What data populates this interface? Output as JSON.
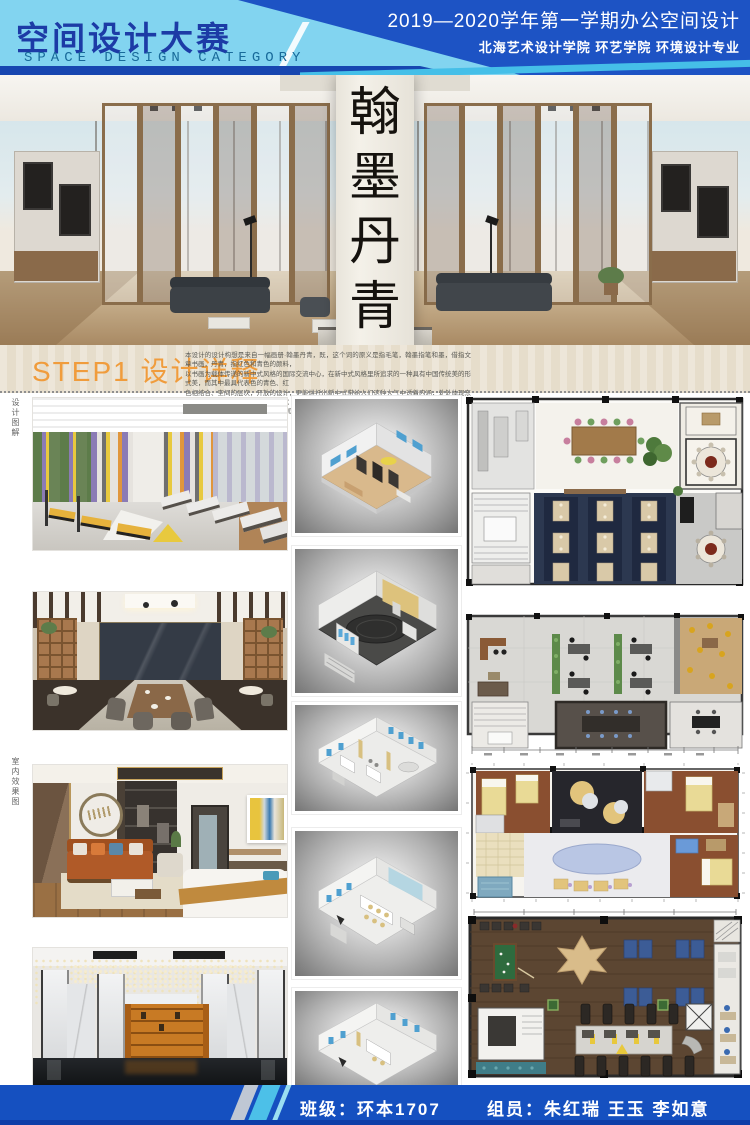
{
  "palette": {
    "header_light_blue": "#82d4f0",
    "header_royal_blue": "#1d53c4",
    "header_navy_text": "#1c3ba6",
    "header_en_text": "#186a9a",
    "accent_cyan": "#45bfe8",
    "step_orange": "#f09c3c",
    "footer_blue": "#1550c0",
    "plan_navy": "#2c3850",
    "axon_window_blue": "#4fa0d0"
  },
  "header": {
    "title_cn": "空间设计大赛",
    "title_en": "SPACE DESIGN CATEGORY",
    "session_line": "2019—2020学年第一学期办公空间设计",
    "school_line": "北海艺术设计学院  环艺学院  环境设计专业"
  },
  "hero": {
    "calligraphy_chars": [
      "翰",
      "墨",
      "丹",
      "青"
    ]
  },
  "step1": {
    "heading": "STEP1 设计详释",
    "paragraph_lines": [
      "本设计的设计构想是来自一幅画册·翰墨丹青，既，这个词的原义是指毛笔，翰墨指笔和墨，借指文章书画，丹青，指红色和青色的颜料，",
      "以书画为载体传递的新中式风格的国际交流中心，在新中式风格里所追求的一种具有中国传统美的形式美，而其中最具代表色的青色、红",
      "色相结合、空间的层次，开放的设计，更能烘托出新中式带给人们这种大气中透着内涵，处处体现东方的韵味，呈现出具有中国风又现代",
      "时尚的气息，丹青温润，习墨设计的国际交流中心的主题内涵并结合相应图案，因此一致"
    ]
  },
  "side_labels": {
    "top": "设计图解",
    "middle": "室内效果图"
  },
  "gallery": {
    "photos": [
      "gym-fitness-room",
      "chinese-restaurant",
      "bedroom-suite",
      "reception-lobby"
    ],
    "axon_models": [
      "axon-library-office",
      "axon-stage-hall",
      "axon-office-floor",
      "axon-meeting-floor",
      "axon-extra-floor"
    ],
    "floor_plans": [
      "plan-restaurant-level",
      "plan-office-level",
      "plan-guestroom-level",
      "plan-gym-level"
    ]
  },
  "footer": {
    "class_text": "班级：环本1707",
    "members_text": "组员：朱红瑞  王玉  李如意"
  }
}
